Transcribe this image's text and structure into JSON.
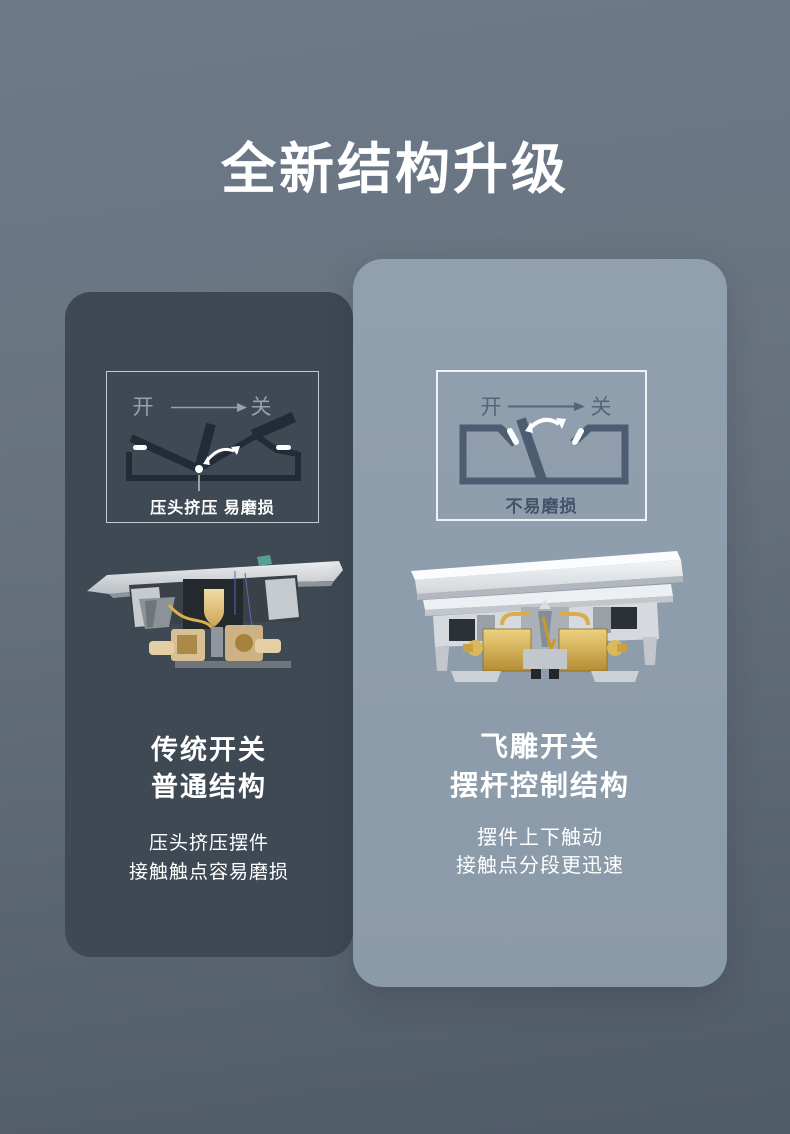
{
  "title": "全新结构升级",
  "colors": {
    "background_top": "#6e7a89",
    "background_bottom": "#505b68",
    "card_left_bg": "#3e4954",
    "card_right_bg": "#8c9baa",
    "text_white": "#ffffff",
    "diagram_dark_mech": "#222c37",
    "diagram_slate_mech": "#4d5d71",
    "diagram_label_muted": "#96a1ac",
    "diagram_label_dark": "#42536a",
    "brass": "#d9b050",
    "gold_block": "#e6c162"
  },
  "cards": {
    "left": {
      "theme": "dark",
      "diagram": {
        "state_on": "开",
        "state_off": "关",
        "caption": "压头挤压 易磨损"
      },
      "illustration": "traditional-switch-cross-section",
      "heading": [
        "传统开关",
        "普通结构"
      ],
      "body": [
        "压头挤压摆件",
        "接触触点容易磨损"
      ]
    },
    "right": {
      "theme": "light",
      "diagram": {
        "state_on": "开",
        "state_off": "关",
        "caption": "不易磨损"
      },
      "illustration": "feidiao-switch-cross-section",
      "heading": [
        "飞雕开关",
        "摆杆控制结构"
      ],
      "body": [
        "摆件上下触动",
        "接触点分段更迅速"
      ]
    }
  }
}
